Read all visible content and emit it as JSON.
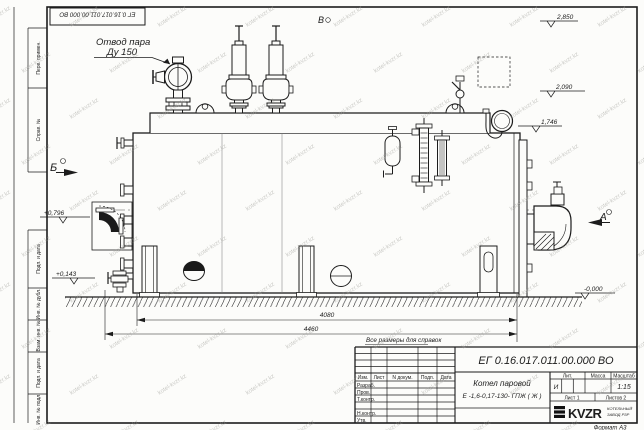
{
  "watermark": {
    "text": "kotel-kvzr.kz"
  },
  "doc": {
    "number": "ЕГ 0.16.017.011.00.000  ВО"
  },
  "callouts": {
    "steam_outlet_line1": "Отвод пара",
    "steam_outlet_line2": "Ду 150"
  },
  "views": {
    "a": "А",
    "b": "Б",
    "v": "В"
  },
  "elevations": {
    "e2850": "2,850",
    "e2090": "2,090",
    "e1746": "1,746",
    "e0796": "+0,796",
    "e0143": "+0,143",
    "e0000": "-0,000"
  },
  "dimensions": {
    "d4080": "4080",
    "d4460": "4460"
  },
  "note": "Все размеры для справок",
  "frame_columns": [
    "Перв. примен.",
    "Справ. №",
    "Подп. и дата",
    "Инв. № дубл.",
    "Взам. инв. №",
    "Подп. и дата",
    "Инв. № подл."
  ],
  "title_block": {
    "doc_number": "ЕГ 0.16.017.011.00.000  ВО",
    "name_line1": "Котел паровой",
    "name_line2": "Е -1,6-0,17-130- ГПЖ ( Ж )",
    "header_izm": "Изм.",
    "header_list": "Лист",
    "header_dokum": "N докум.",
    "header_podp": "Подп.",
    "header_data": "Дата",
    "row_razrab": "Разраб.",
    "row_prov": "Пров.",
    "row_tkontr": "Т.контр.",
    "row_nkontr": "Н.контр.",
    "row_utv": "Утв.",
    "lit_label": "Лит.",
    "mass_label": "Масса",
    "scale_label": "Масштаб",
    "lit_value": "И",
    "scale_value": "1:15",
    "sheet": "Лист 1",
    "sheets": "Листов 2",
    "logo": "KVZR",
    "logo_sub1": "КОТЕЛЬНЫЙ",
    "logo_sub2": "ЗАВОД РЗР",
    "format": "Формат А3"
  }
}
